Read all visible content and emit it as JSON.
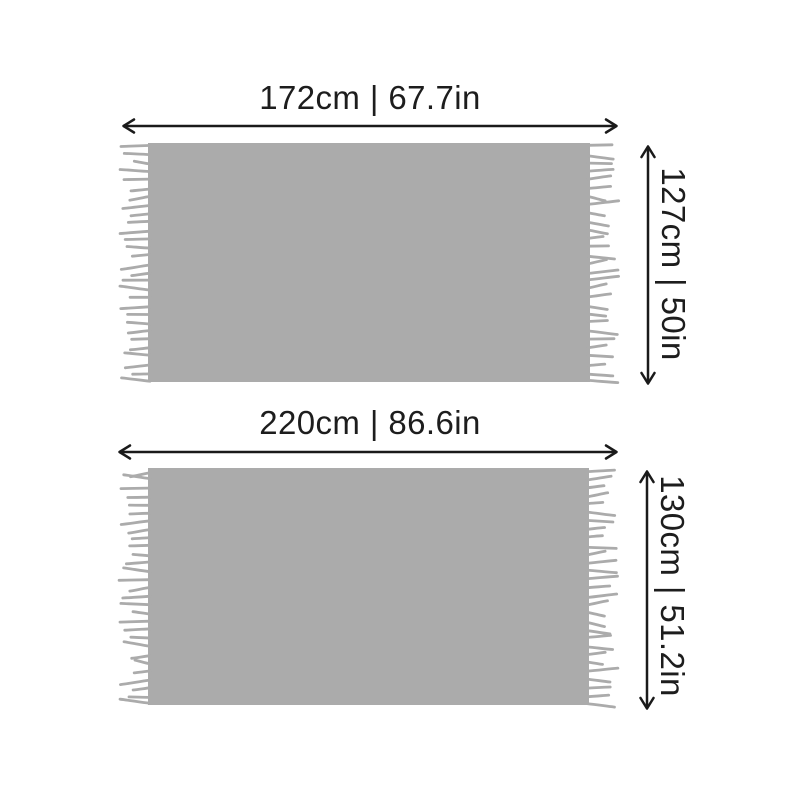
{
  "title": "blanket-size-diagram",
  "colors": {
    "background": "#ffffff",
    "blanket": "#ababab",
    "dimension_line": "#1a1a1a",
    "label_text": "#1d1d1d"
  },
  "figures": [
    {
      "id": "blanket-small",
      "width_label": "172cm | 67.7in",
      "height_label": "127cm | 50in"
    },
    {
      "id": "blanket-large",
      "width_label": "220cm | 86.6in",
      "height_label": "130cm | 51.2in"
    }
  ]
}
